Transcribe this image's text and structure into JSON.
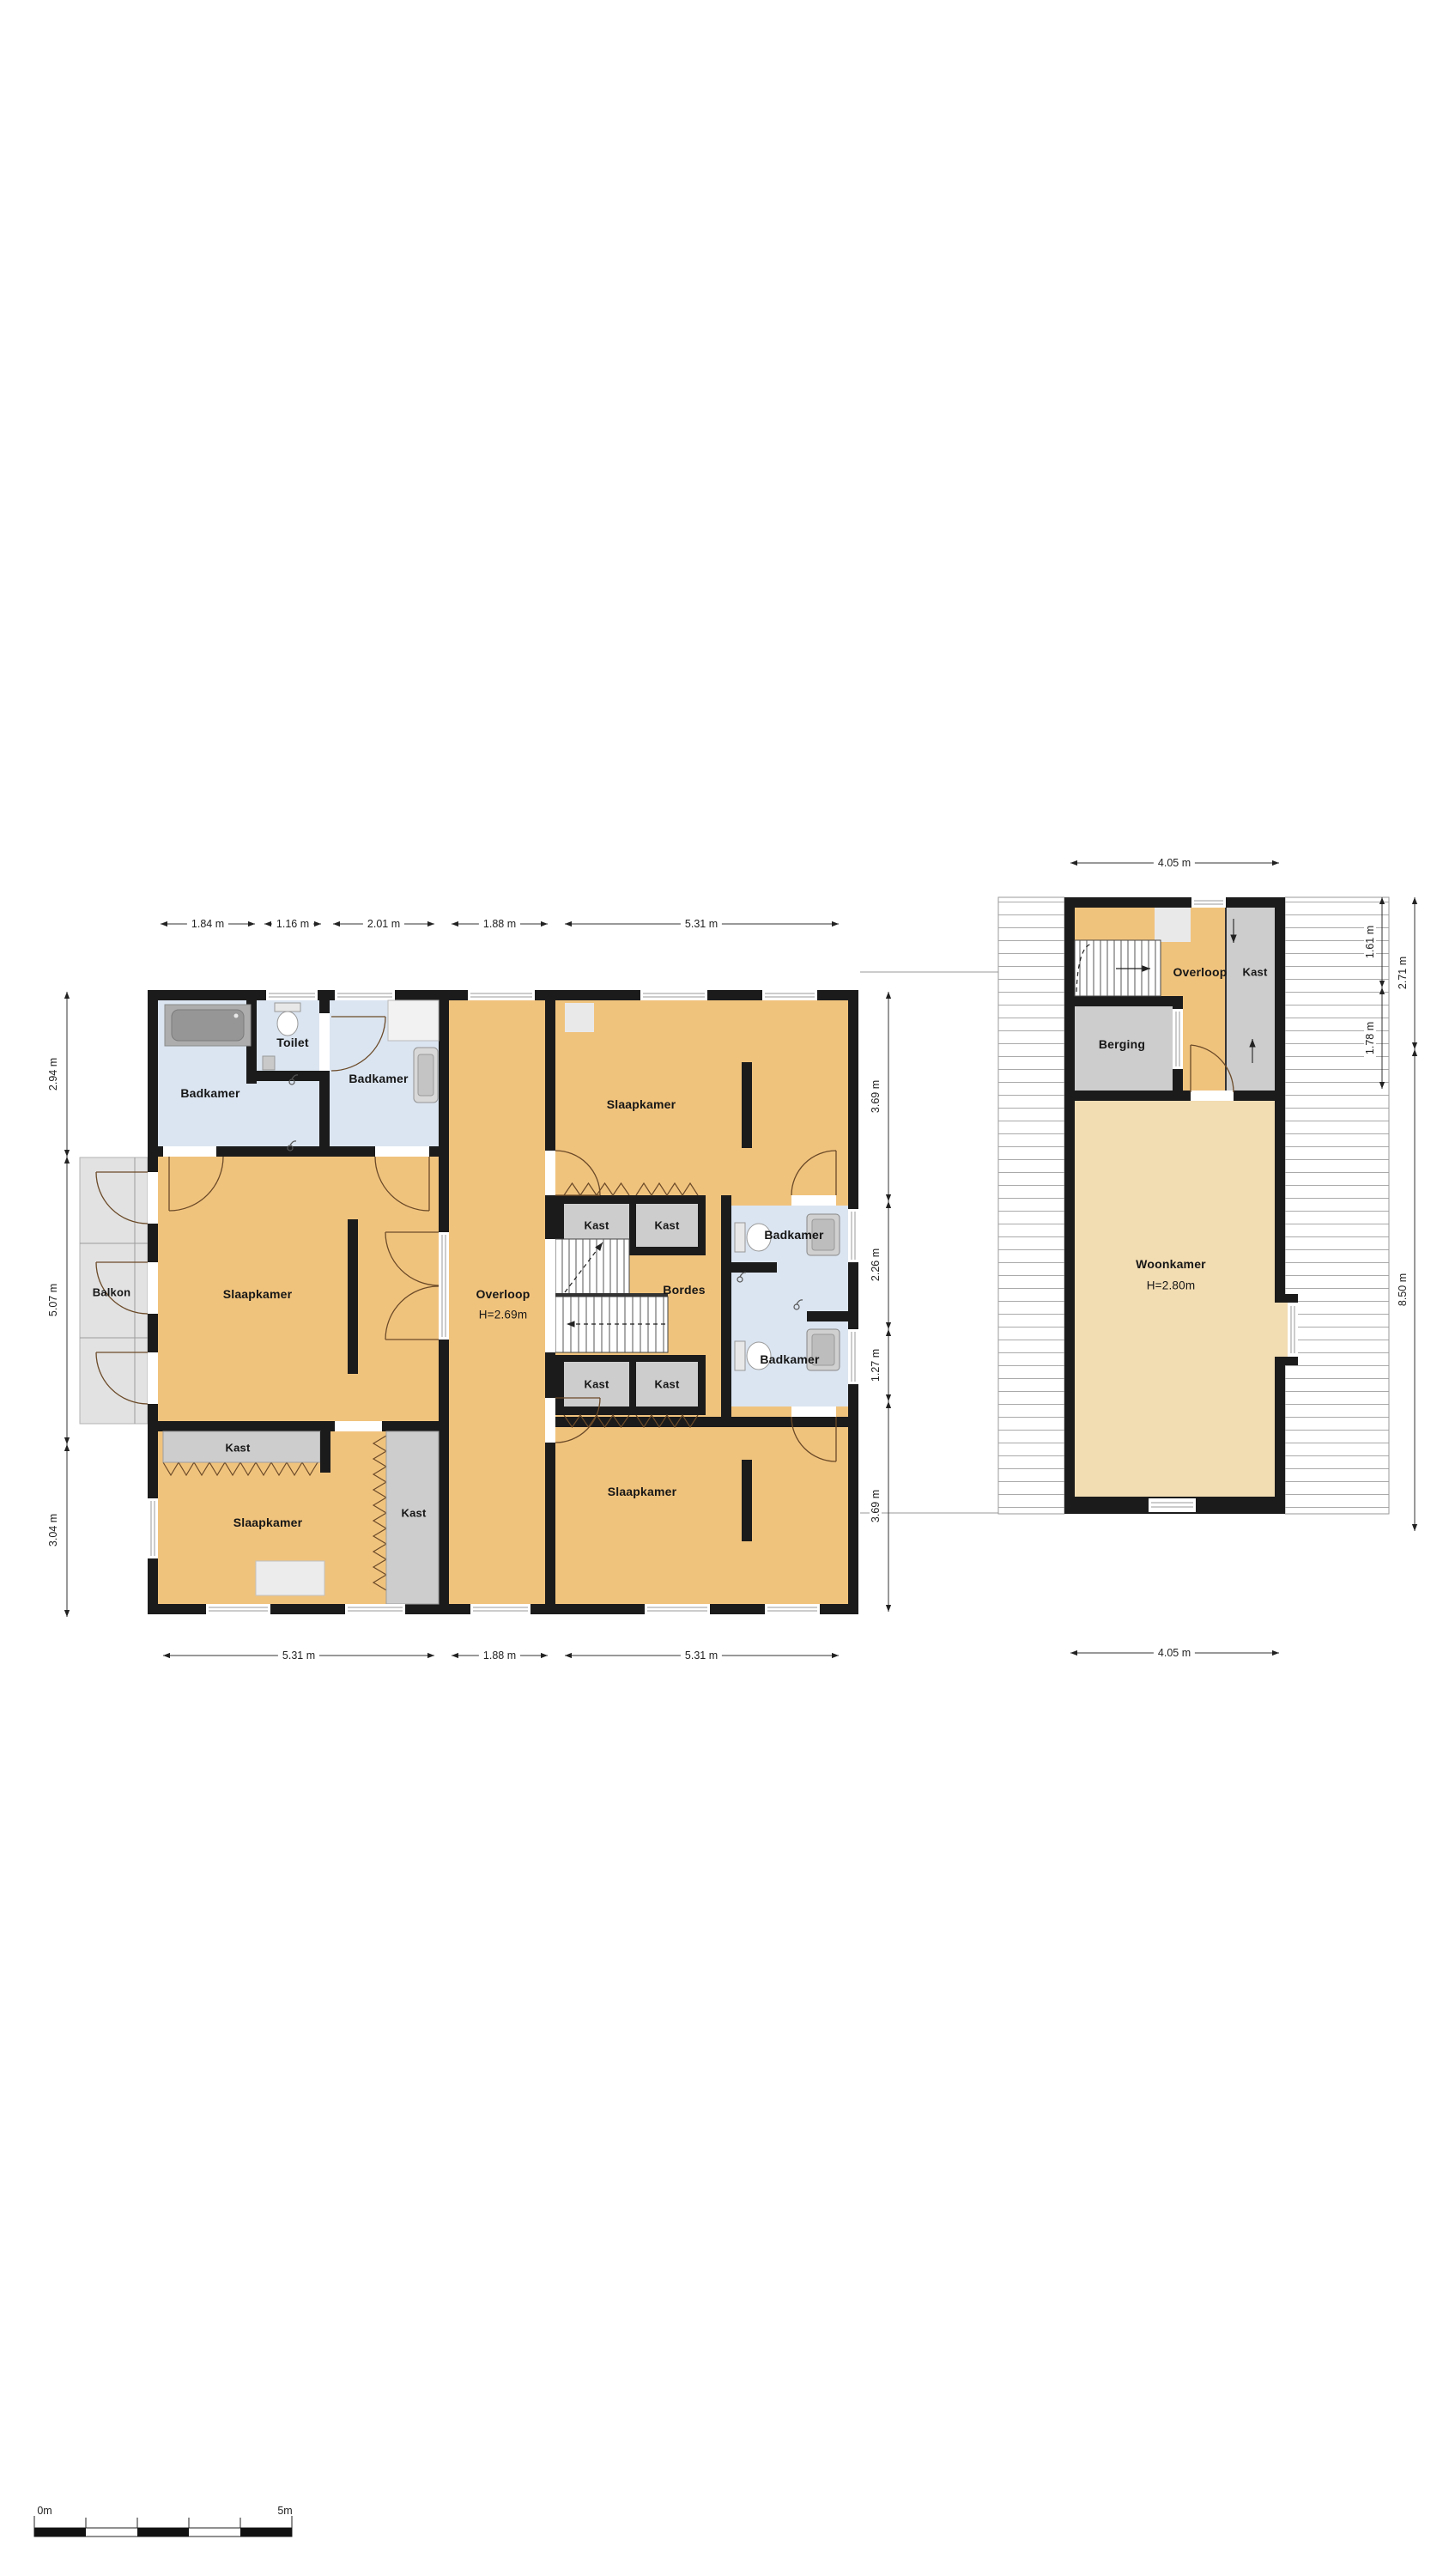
{
  "colors": {
    "wall": "#1b1b1b",
    "room_orange": "#f0c37d",
    "room_tan": "#f2dcb2",
    "room_blue": "#dbe5f1",
    "closet_gray": "#cdcdcd",
    "balcony_gray": "#e2e2e2"
  },
  "floor1": {
    "labels": {
      "badkamer_nw": "Badkamer",
      "toilet": "Toilet",
      "badkamer_n": "Badkamer",
      "slaapkamer_w": "Slaapkamer",
      "balkon": "Balkon",
      "overloop": "Overloop",
      "overloop_h": "H=2.69m",
      "kast_band_nw": "Kast",
      "kast_band_ne": "Kast",
      "bordes": "Bordes",
      "kast_band_sw": "Kast",
      "kast_band_se": "Kast",
      "badkamer_e1": "Badkamer",
      "badkamer_e2": "Badkamer",
      "slaapkamer_ne": "Slaapkamer",
      "slaapkamer_se": "Slaapkamer",
      "slaapkamer_sw": "Slaapkamer",
      "kast_closet_h": "Kast",
      "kast_closet_v": "Kast"
    },
    "dims": {
      "top": [
        "1.84 m",
        "1.16 m",
        "2.01 m",
        "1.88 m",
        "5.31 m"
      ],
      "bottom": [
        "5.31 m",
        "1.88 m",
        "5.31 m"
      ],
      "left": [
        "2.94 m",
        "5.07 m",
        "3.04 m"
      ],
      "right": [
        "3.69 m",
        "2.26 m",
        "1.27 m",
        "3.69 m"
      ]
    }
  },
  "floor2": {
    "labels": {
      "overloop": "Overloop",
      "kast": "Kast",
      "berging": "Berging",
      "woonkamer": "Woonkamer",
      "woonkamer_h": "H=2.80m"
    },
    "dims": {
      "top": "4.05 m",
      "bottom": "4.05 m",
      "right_inner": [
        "1.61 m",
        "1.78 m"
      ],
      "right_outer": [
        "2.71 m",
        "8.50 m"
      ]
    }
  },
  "scalebar": {
    "start": "0m",
    "end": "5m"
  }
}
